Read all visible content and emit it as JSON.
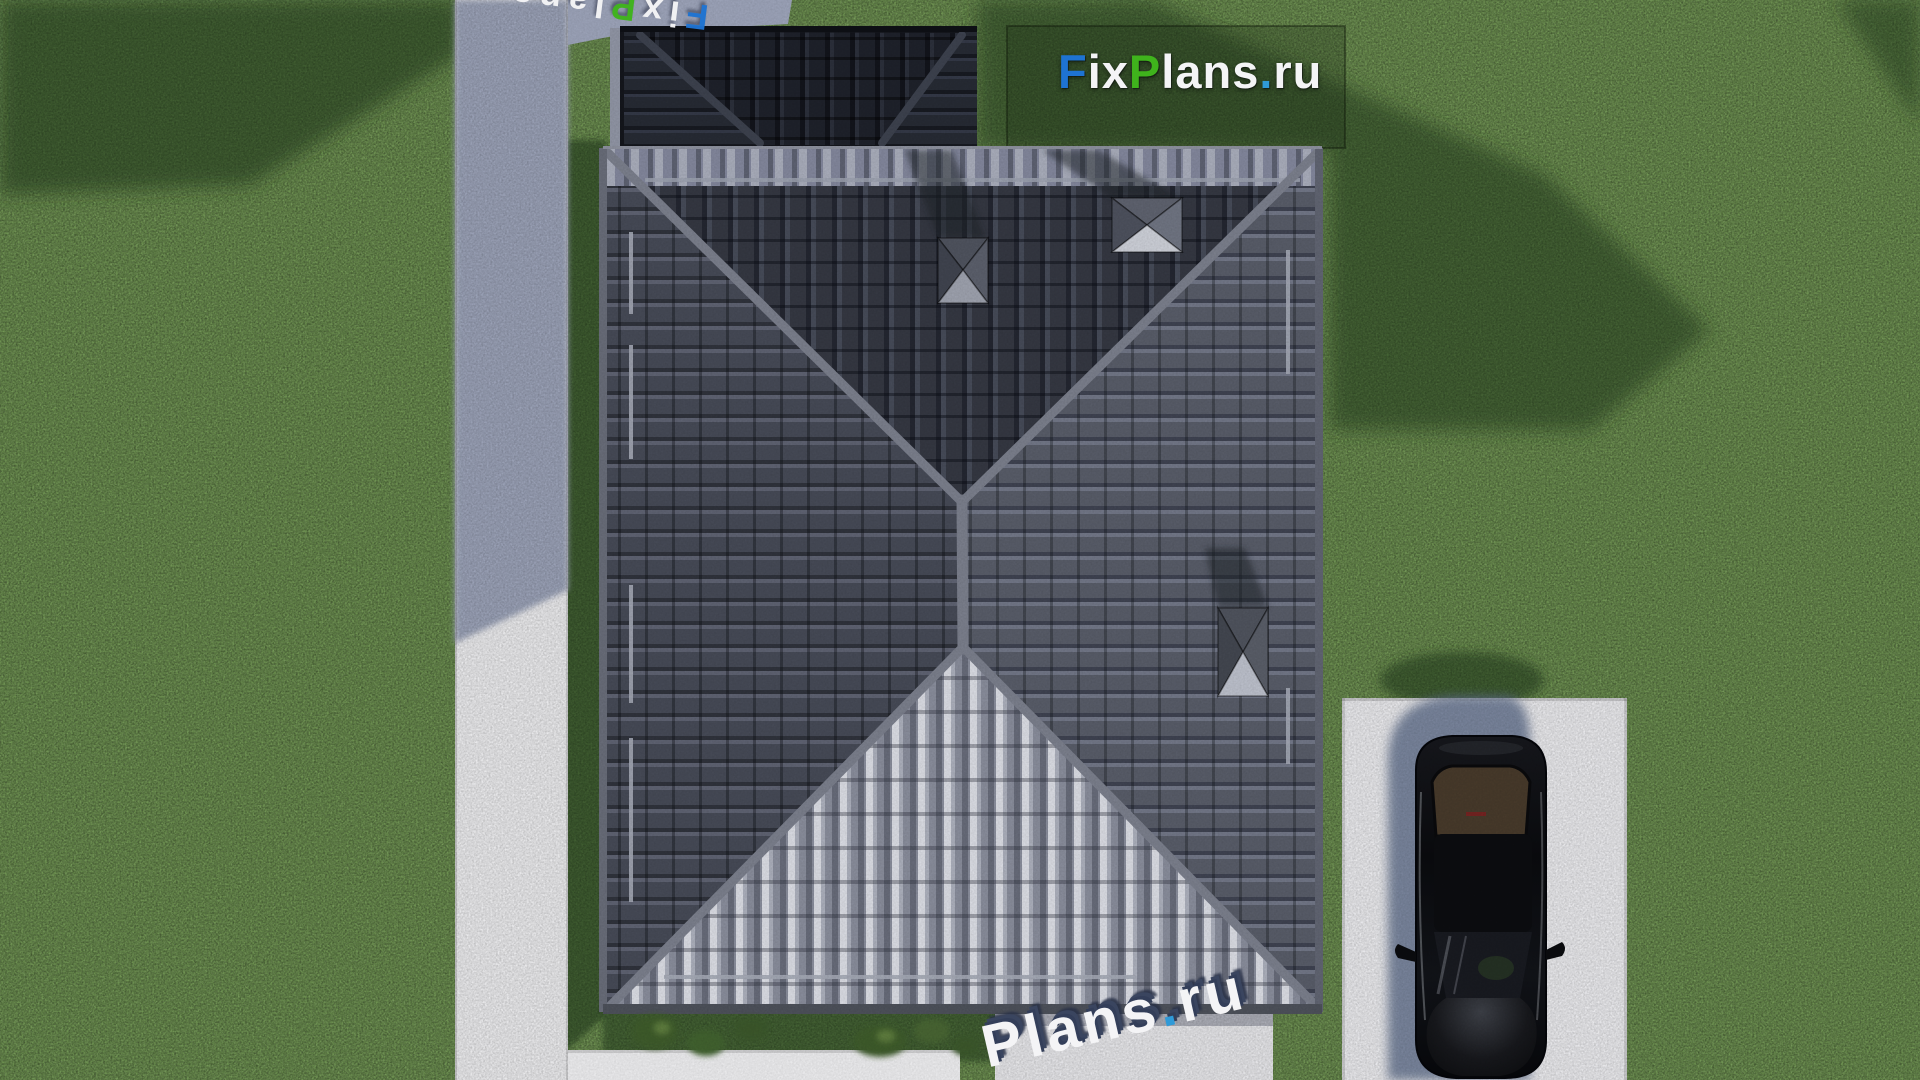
{
  "branding": {
    "site_logo": {
      "text_full": "FixPlans.ru",
      "parts": {
        "f": "F",
        "ix": "ix",
        "p": "P",
        "lans": "lans",
        "dot": ".",
        "ru": "ru"
      },
      "colors": {
        "blue": "#1e73d2",
        "green": "#3fb31c",
        "dot_blue": "#2f9ad8",
        "white": "#f4f4f6"
      }
    },
    "watermark_top": {
      "text_full": "FixPlans.ru",
      "parts": {
        "f": "F",
        "ix": "ix",
        "p": "P",
        "lans": "lans",
        "dot": ".",
        "ru": "ru"
      }
    },
    "watermark_bottom": {
      "text_full": "Plans.ru",
      "parts": {
        "p": "P",
        "lans": "lans",
        "dot": ".",
        "ru": "ru"
      }
    }
  },
  "palette": {
    "grass": "#6d9150",
    "grass_shadow": "#243a1c",
    "roof_tile_north": "#343741",
    "roof_tile_west": "#454955",
    "roof_tile_east": "#575b67",
    "roof_tile_south": "#878b99",
    "roof_ridge": "#797d8a",
    "extension_roof": "#1e212a",
    "concrete_sunlit": "#e8e8ea",
    "concrete_shadow": "#99a0b5",
    "car_body": "#0b0c0e"
  }
}
